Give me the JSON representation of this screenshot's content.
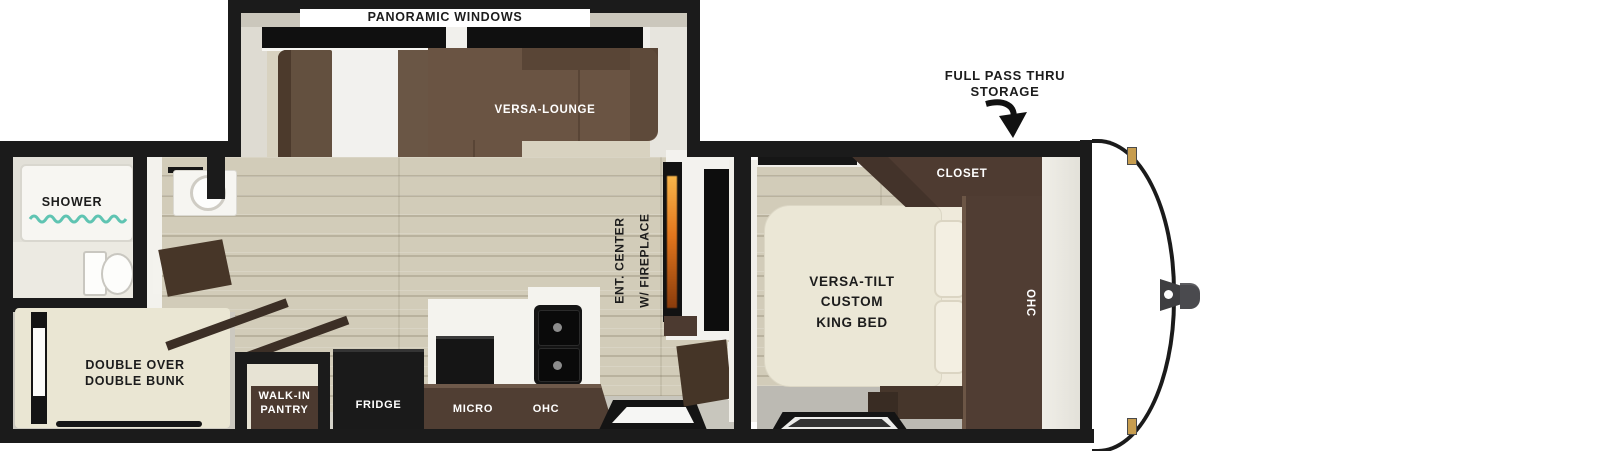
{
  "title": "travel trailer floor plan",
  "labels": {
    "slideout": {
      "panoramic_windows": "PANORAMIC WINDOWS",
      "versa_lounge": "VERSA-LOUNGE"
    },
    "storage": {
      "full_pass_thru": "FULL PASS THRU\nSTORAGE"
    },
    "bathroom": {
      "shower": "SHOWER"
    },
    "bunk_room": {
      "double_bunk": "DOUBLE OVER\nDOUBLE BUNK",
      "walk_in_pantry": "WALK-IN\nPANTRY"
    },
    "kitchen": {
      "fridge": "FRIDGE",
      "micro": "MICRO",
      "ohc": "OHC"
    },
    "living": {
      "ent_center": "ENT. CENTER\nW/ FIREPLACE"
    },
    "bedroom": {
      "closet": "CLOSET",
      "ohc": "OHC",
      "king_bed": "VERSA-TILT\nCUSTOM\nKING BED"
    }
  },
  "colors": {
    "wall": "#1b1b1b",
    "sofa_brown": "#6a5443",
    "cabinet_brown": "#4e3b31",
    "bed_cream": "#ebe7d6",
    "floor_wood": "#d2ccb9",
    "floor_gray": "#bcbab3",
    "shower_glass": "#5fc4b2",
    "fireplace_flame": "#e2761d",
    "gold_marker": "#c79d4f",
    "hitch_gray": "#46464a"
  }
}
